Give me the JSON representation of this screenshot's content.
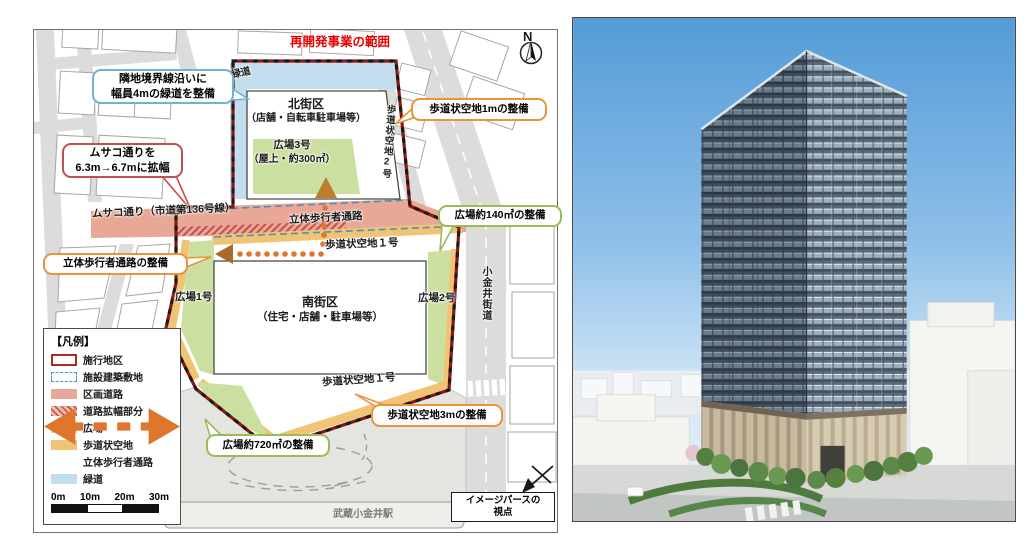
{
  "map": {
    "range_label": "再開発事業の範囲",
    "compass_n": "N",
    "blocks": {
      "north_name": "北街区",
      "north_use": "（店舗・自転車駐車場等）",
      "south_name": "南街区",
      "south_use": "（住宅・店舗・駐車場等）"
    },
    "areas": {
      "greenway": "緑道",
      "plaza3_name": "広場3号",
      "plaza3_note": "（屋上・約300㎡）",
      "plaza1": "広場1号",
      "plaza2": "広場2号",
      "walkspace1_upper": "歩道状空地１号",
      "walkspace1_lower": "歩道状空地１号",
      "walkspace2": "歩道状空地2号"
    },
    "roads": {
      "musako": "ムサコ通り（市道第136号線）",
      "pedestrian_deck": "立体歩行者通路",
      "koganei": "小金井街道",
      "station": "武蔵小金井駅"
    },
    "callouts": {
      "greenway": {
        "line1": "隣地境界線沿いに",
        "line2": "幅員4mの緑道を整備"
      },
      "musako_widen": {
        "line1": "ムサコ通りを",
        "line2": "6.3m→6.7mに拡幅"
      },
      "walkspace_1m": "歩道状空地1mの整備",
      "plaza_140": "広場約140㎡の整備",
      "deck": "立体歩行者通路の整備",
      "walkspace_3m": "歩道状空地3mの整備",
      "plaza_720": "広場約720㎡の整備"
    },
    "viewpoint": {
      "line1": "イメージパースの",
      "line2": "視点"
    },
    "legend": {
      "title": "【凡例】",
      "items": [
        {
          "label": "施行地区"
        },
        {
          "label": "施設建築敷地"
        },
        {
          "label": "区画道路"
        },
        {
          "label": "道路拡幅部分"
        },
        {
          "label": "広場"
        },
        {
          "label": "歩道状空地"
        },
        {
          "label": "立体歩行者通路"
        },
        {
          "label": "緑道"
        }
      ],
      "scale": [
        "0m",
        "10m",
        "20m",
        "30m"
      ]
    },
    "colors": {
      "boundary": "#8e1711",
      "district_road": "#e9a896",
      "plaza": "#cbe0a0",
      "walk_space": "#f0c474",
      "greenway": "#c3ddf0",
      "deck_dots": "#e0762e",
      "range_text": "#e60000"
    }
  }
}
